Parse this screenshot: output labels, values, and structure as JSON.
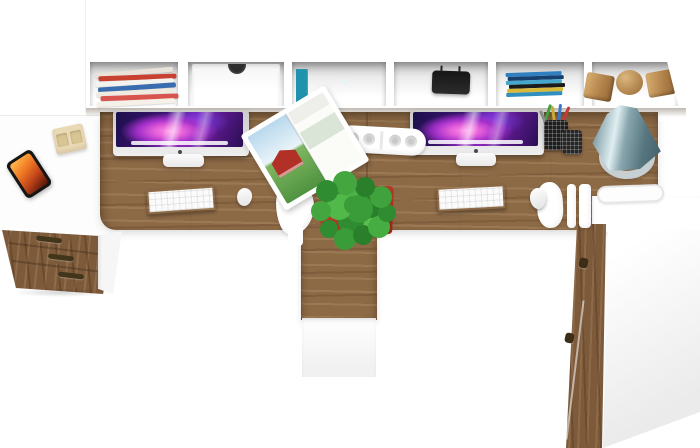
{
  "scene": {
    "label": "Top-down 3D render of a white and oak double computer workstation with wall shelf, two iMacs, plant and storage cabinets",
    "background": "#ffffff"
  },
  "palette": {
    "oak": "#8d6a46",
    "oak_dark": "#6e4f33",
    "oak_decor": "#b08048",
    "white": "#ffffff",
    "pot_red": "#c0392b",
    "plant_green": "#3a9c38",
    "lamp_teal": "#7b98a2",
    "screen_magenta": "#e45fd9",
    "screen_violet": "#3c1470",
    "phone_screen_orange": "#f07a24"
  },
  "shelf": {
    "label": "white wall shelf unit with six open compartments",
    "compartments": [
      {
        "content": "stack of magazines",
        "strip_colors": [
          "#e8e2d8",
          "#c8402f",
          "#f2f2ee",
          "#3a6db0",
          "#efe9df",
          "#d9534f",
          "#f5f1e8"
        ]
      },
      {
        "content": "white drawer front with dark finger hole"
      },
      {
        "content": "row of standing books",
        "book_colors": [
          "#7a2330",
          "#1d2742",
          "#2f6cb4",
          "#24512f",
          "#6e2026",
          "#ddd3c2",
          "#1f93ad"
        ],
        "book_widths": [
          7,
          7,
          8,
          8,
          7,
          6,
          12
        ]
      },
      {
        "content": "black portable speaker"
      },
      {
        "content": "flat stack of DVD cases",
        "dvd_colors": [
          "#2f7fc1",
          "#17406e",
          "#45a7cc",
          "#1b1b1b",
          "#d9b93a",
          "#2f8fbf"
        ]
      },
      {
        "content": "two wooden cubes and a wooden sphere"
      }
    ]
  },
  "labels": {
    "shelf": "wall shelf unit",
    "shelf_magazines": "stack of magazines",
    "shelf_drawer": "shelf drawer with finger hole",
    "shelf_books": "row of books",
    "shelf_speaker": "black speaker",
    "shelf_dvds": "stack of DVD cases",
    "wood_cube": "decorative wooden cube",
    "wood_sphere": "decorative wooden sphere",
    "desktop": "oak double desktop surface",
    "desk_seam": "seam between the two desks",
    "pedestal": "center oak pedestal cabinet",
    "left_return": "white left return desk",
    "smartphone": "smartphone with fiery wallpaper",
    "wood_clock": "small wooden desk clock",
    "drawer_cabinet": "oak three-drawer cabinet",
    "drawer_handle": "drawer handle",
    "right_cabinet": "tall white cabinet with oak front edge",
    "cabinet_handle": "cabinet handle",
    "paper_tray": "white paper tray",
    "chair": "white chair seen from above",
    "imac": "Apple iMac computer",
    "imac_screen": "iMac screen with purple galaxy wallpaper",
    "imac_stand": "iMac stand",
    "apple_logo": "Apple logo",
    "keyboard": "white keyboard",
    "mouse": "white mouse",
    "power_strip": "white power strip",
    "magazine": "open magazine with red barn farm photo",
    "pen_cup": "mesh pen cup with pens",
    "lamp": "teal cone desk lamp",
    "lamp_ring": "lamp ring base",
    "plant": "green potted plant",
    "plant_pot": "red plant pot"
  },
  "desks": {
    "left": {
      "items": [
        "iMac computer",
        "white keyboard",
        "white mouse",
        "open magazine",
        "white chair"
      ]
    },
    "center": {
      "items": [
        "white power strip",
        "green plant in red pot on oak pedestal"
      ]
    },
    "right": {
      "items": [
        "iMac computer",
        "white keyboard",
        "white mouse",
        "pen cups",
        "teal desk lamp",
        "white chair",
        "paper tray"
      ]
    }
  },
  "left_return": {
    "items": [
      "smartphone",
      "wooden desk clock"
    ],
    "cabinet_drawers": 3
  },
  "right_cabinet": {
    "handles": 2
  }
}
